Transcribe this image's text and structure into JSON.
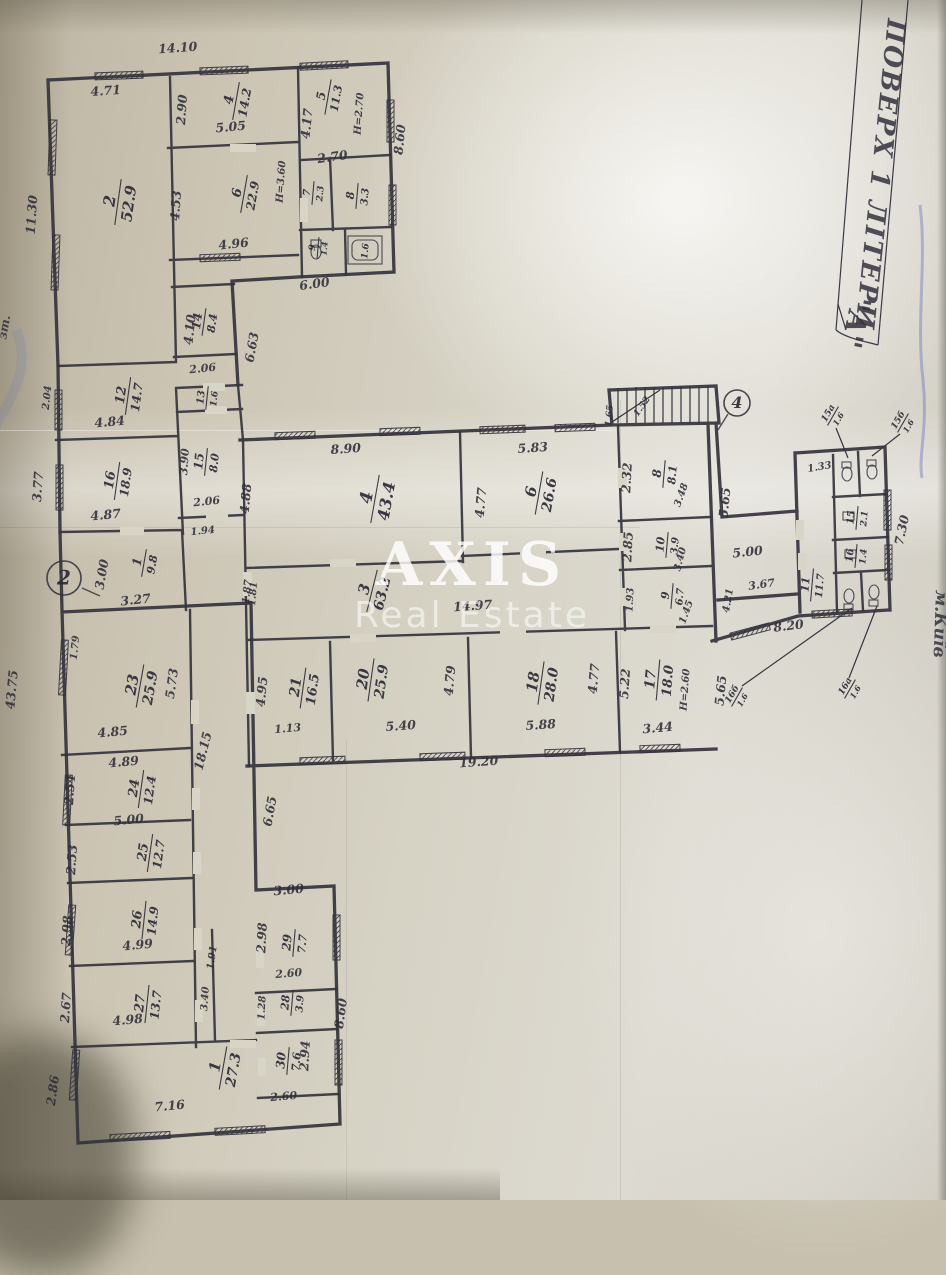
{
  "document": {
    "side_title": "ПОВЕРХ 1 ЛІТЕРИ",
    "side_letter": "\"А\"",
    "city_note": "м.Київ",
    "margin_note": "зт.",
    "watermark": {
      "line1": "AXIS",
      "line2": "Real Estate"
    },
    "ink_color": "#34333d",
    "paper_color": "#d6d2c4"
  },
  "plan": {
    "markers": [
      {
        "label": "2",
        "x": 64,
        "y": 578,
        "r": 17,
        "ax": 82,
        "ay": 588,
        "bx": 100,
        "by": 596
      },
      {
        "label": "4",
        "x": 737,
        "y": 403,
        "r": 13,
        "ax": 728,
        "ay": 414,
        "bx": 718,
        "by": 430
      }
    ],
    "rooms": [
      {
        "n": "2",
        "a": "52.9",
        "x": 118,
        "y": 202,
        "rot": -82,
        "s": 16
      },
      {
        "n": "4",
        "a": "14.2",
        "x": 236,
        "y": 101,
        "rot": -80,
        "s": 13
      },
      {
        "n": "6",
        "a": "22.9",
        "x": 244,
        "y": 194,
        "rot": -80,
        "s": 13
      },
      {
        "n": "5",
        "a": "11.3",
        "x": 328,
        "y": 97,
        "rot": -80,
        "s": 12
      },
      {
        "n": "7",
        "a": "2.3",
        "x": 313,
        "y": 193,
        "rot": -85,
        "s": 10
      },
      {
        "n": "8",
        "a": "3.3",
        "x": 357,
        "y": 196,
        "rot": -85,
        "s": 11
      },
      {
        "n": "9",
        "a": "1.4",
        "x": 318,
        "y": 248,
        "rot": -85,
        "s": 9
      },
      {
        "n": null,
        "a": "1.6",
        "x": 364,
        "y": 251,
        "rot": -85,
        "s": 9
      },
      {
        "n": "14",
        "a": "8.4",
        "x": 204,
        "y": 322,
        "rot": -82,
        "s": 12
      },
      {
        "n": "12",
        "a": "14.7",
        "x": 128,
        "y": 396,
        "rot": -82,
        "s": 13
      },
      {
        "n": "13",
        "a": "1.6",
        "x": 207,
        "y": 398,
        "rot": -84,
        "s": 10
      },
      {
        "n": "15",
        "a": "8.0",
        "x": 206,
        "y": 462,
        "rot": -84,
        "s": 12
      },
      {
        "n": "16",
        "a": "18.9",
        "x": 117,
        "y": 481,
        "rot": -82,
        "s": 13
      },
      {
        "n": "1",
        "a": "9.8",
        "x": 144,
        "y": 563,
        "rot": -80,
        "s": 12
      },
      {
        "n": "23",
        "a": "25.9",
        "x": 140,
        "y": 686,
        "rot": -80,
        "s": 15
      },
      {
        "n": "24",
        "a": "12.4",
        "x": 141,
        "y": 789,
        "rot": -82,
        "s": 13
      },
      {
        "n": "25",
        "a": "12.7",
        "x": 150,
        "y": 853,
        "rot": -82,
        "s": 13
      },
      {
        "n": "26",
        "a": "14.9",
        "x": 144,
        "y": 920,
        "rot": -84,
        "s": 13
      },
      {
        "n": "27",
        "a": "13.7",
        "x": 147,
        "y": 1004,
        "rot": -84,
        "s": 13
      },
      {
        "n": "1",
        "a": "27.3",
        "x": 223,
        "y": 1068,
        "rot": -80,
        "s": 15
      },
      {
        "n": "29",
        "a": "7.7",
        "x": 294,
        "y": 943,
        "rot": -85,
        "s": 12
      },
      {
        "n": "28",
        "a": "3.9",
        "x": 292,
        "y": 1003,
        "rot": -85,
        "s": 11
      },
      {
        "n": "30",
        "a": "7.6",
        "x": 288,
        "y": 1061,
        "rot": -85,
        "s": 12
      },
      {
        "n": "4",
        "a": "43.4",
        "x": 375,
        "y": 499,
        "rot": -80,
        "s": 17
      },
      {
        "n": "6",
        "a": "26.6",
        "x": 539,
        "y": 493,
        "rot": -80,
        "s": 15
      },
      {
        "n": "3",
        "a": "63.2",
        "x": 372,
        "y": 591,
        "rot": -76,
        "s": 15
      },
      {
        "n": "8",
        "a": "8.1",
        "x": 664,
        "y": 474,
        "rot": -85,
        "s": 12
      },
      {
        "n": "10",
        "a": "3.9",
        "x": 667,
        "y": 545,
        "rot": -85,
        "s": 11
      },
      {
        "n": "9",
        "a": "6.7",
        "x": 672,
        "y": 596,
        "rot": -85,
        "s": 11
      },
      {
        "n": "21",
        "a": "16.5",
        "x": 303,
        "y": 688,
        "rot": -82,
        "s": 14
      },
      {
        "n": "20",
        "a": "25.9",
        "x": 371,
        "y": 680,
        "rot": -82,
        "s": 15
      },
      {
        "n": "18",
        "a": "28.0",
        "x": 541,
        "y": 683,
        "rot": -82,
        "s": 15
      },
      {
        "n": "17",
        "a": "18.0",
        "x": 658,
        "y": 680,
        "rot": -85,
        "s": 14
      },
      {
        "n": "11",
        "a": "11.7",
        "x": 812,
        "y": 585,
        "rot": -85,
        "s": 11
      },
      {
        "n": "15",
        "a": "2.1",
        "x": 857,
        "y": 518,
        "rot": -85,
        "s": 10
      },
      {
        "n": "16",
        "a": "1.4",
        "x": 856,
        "y": 556,
        "rot": -85,
        "s": 10
      },
      {
        "n": "15а",
        "a": "1.6",
        "x": 833,
        "y": 416,
        "rot": -60,
        "s": 9
      },
      {
        "n": "15б",
        "a": "1.6",
        "x": 903,
        "y": 423,
        "rot": -60,
        "s": 9
      },
      {
        "n": "16б",
        "a": "1.6",
        "x": 737,
        "y": 697,
        "rot": -60,
        "s": 9
      },
      {
        "n": "16а",
        "a": "1.6",
        "x": 850,
        "y": 689,
        "rot": -60,
        "s": 9
      }
    ],
    "dims": [
      {
        "t": "14.10",
        "x": 178,
        "y": 52,
        "rot": -4
      },
      {
        "t": "4.71",
        "x": 106,
        "y": 95,
        "rot": -4
      },
      {
        "t": "11.30",
        "x": 36,
        "y": 215,
        "rot": -86
      },
      {
        "t": "2.90",
        "x": 186,
        "y": 110,
        "rot": -86
      },
      {
        "t": "5.05",
        "x": 231,
        "y": 131,
        "rot": -5
      },
      {
        "t": "4.53",
        "x": 180,
        "y": 206,
        "rot": -86
      },
      {
        "t": "4.96",
        "x": 234,
        "y": 248,
        "rot": -6
      },
      {
        "t": "Н=3.60",
        "x": 284,
        "y": 182,
        "rot": -86,
        "s": 10
      },
      {
        "t": "4.17",
        "x": 311,
        "y": 124,
        "rot": -84
      },
      {
        "t": "Н=2.70",
        "x": 362,
        "y": 114,
        "rot": -86,
        "s": 10
      },
      {
        "t": "8.60",
        "x": 404,
        "y": 140,
        "rot": -84
      },
      {
        "t": "2.70",
        "x": 333,
        "y": 161,
        "rot": -8
      },
      {
        "t": "6.00",
        "x": 315,
        "y": 288,
        "rot": -8
      },
      {
        "t": "4.10",
        "x": 194,
        "y": 330,
        "rot": -84
      },
      {
        "t": "2.06",
        "x": 203,
        "y": 372,
        "rot": -6,
        "s": 11
      },
      {
        "t": "6.63",
        "x": 256,
        "y": 348,
        "rot": -80
      },
      {
        "t": "3.90",
        "x": 188,
        "y": 462,
        "rot": -86,
        "s": 11
      },
      {
        "t": "2.06",
        "x": 207,
        "y": 505,
        "rot": -6,
        "s": 11
      },
      {
        "t": "1.94",
        "x": 203,
        "y": 534,
        "rot": -6,
        "s": 10
      },
      {
        "t": "1.87",
        "x": 250,
        "y": 592,
        "rot": -84,
        "s": 10
      },
      {
        "t": "4.84",
        "x": 110,
        "y": 426,
        "rot": -5
      },
      {
        "t": "2.04",
        "x": 50,
        "y": 398,
        "rot": -84,
        "s": 10
      },
      {
        "t": "4.87",
        "x": 106,
        "y": 519,
        "rot": -5
      },
      {
        "t": "3.77",
        "x": 42,
        "y": 487,
        "rot": -86
      },
      {
        "t": "3.00",
        "x": 106,
        "y": 575,
        "rot": -80
      },
      {
        "t": "3.27",
        "x": 136,
        "y": 604,
        "rot": -6
      },
      {
        "t": "43.75",
        "x": 16,
        "y": 690,
        "rot": -85
      },
      {
        "t": "1.79",
        "x": 78,
        "y": 648,
        "rot": -84,
        "s": 10
      },
      {
        "t": "5.73",
        "x": 176,
        "y": 684,
        "rot": -82
      },
      {
        "t": "18.15",
        "x": 207,
        "y": 752,
        "rot": -76
      },
      {
        "t": "4.85",
        "x": 113,
        "y": 736,
        "rot": -5
      },
      {
        "t": "4.89",
        "x": 124,
        "y": 766,
        "rot": -5
      },
      {
        "t": "2.54",
        "x": 74,
        "y": 790,
        "rot": -86
      },
      {
        "t": "5.00",
        "x": 129,
        "y": 824,
        "rot": -5
      },
      {
        "t": "2.53",
        "x": 76,
        "y": 860,
        "rot": -86
      },
      {
        "t": "4.99",
        "x": 138,
        "y": 949,
        "rot": -5
      },
      {
        "t": "2.98",
        "x": 71,
        "y": 931,
        "rot": -86
      },
      {
        "t": "4.98",
        "x": 128,
        "y": 1024,
        "rot": -5
      },
      {
        "t": "2.67",
        "x": 70,
        "y": 1008,
        "rot": -86
      },
      {
        "t": "1.91",
        "x": 215,
        "y": 958,
        "rot": -82,
        "s": 10
      },
      {
        "t": "3.40",
        "x": 208,
        "y": 999,
        "rot": -86,
        "s": 10
      },
      {
        "t": "7.16",
        "x": 170,
        "y": 1110,
        "rot": -5
      },
      {
        "t": "2.86",
        "x": 57,
        "y": 1091,
        "rot": -82
      },
      {
        "t": "6.65",
        "x": 274,
        "y": 812,
        "rot": -80
      },
      {
        "t": "3.00",
        "x": 289,
        "y": 894,
        "rot": -5
      },
      {
        "t": "2.98",
        "x": 266,
        "y": 938,
        "rot": -87
      },
      {
        "t": "2.60",
        "x": 289,
        "y": 977,
        "rot": -5,
        "s": 11
      },
      {
        "t": "1.28",
        "x": 265,
        "y": 1008,
        "rot": -87,
        "s": 10
      },
      {
        "t": "2.94",
        "x": 309,
        "y": 1056,
        "rot": -87
      },
      {
        "t": "2.60",
        "x": 284,
        "y": 1100,
        "rot": -5,
        "s": 11
      },
      {
        "t": "8.60",
        "x": 345,
        "y": 1014,
        "rot": -82
      },
      {
        "t": "8.90",
        "x": 346,
        "y": 453,
        "rot": -4
      },
      {
        "t": "4.88",
        "x": 250,
        "y": 499,
        "rot": -85
      },
      {
        "t": "5.83",
        "x": 533,
        "y": 452,
        "rot": -4
      },
      {
        "t": "4.77",
        "x": 485,
        "y": 503,
        "rot": -85
      },
      {
        "t": "1.81",
        "x": 256,
        "y": 594,
        "rot": -85,
        "s": 10
      },
      {
        "t": "14.97",
        "x": 473,
        "y": 610,
        "rot": -4
      },
      {
        "t": "4.95",
        "x": 266,
        "y": 692,
        "rot": -85
      },
      {
        "t": "1.13",
        "x": 288,
        "y": 732,
        "rot": -5,
        "s": 11
      },
      {
        "t": "5.40",
        "x": 401,
        "y": 730,
        "rot": -4
      },
      {
        "t": "4.79",
        "x": 454,
        "y": 681,
        "rot": -85
      },
      {
        "t": "5.88",
        "x": 541,
        "y": 729,
        "rot": -4
      },
      {
        "t": "4.77",
        "x": 598,
        "y": 679,
        "rot": -85
      },
      {
        "t": "5.22",
        "x": 629,
        "y": 684,
        "rot": -86
      },
      {
        "t": "3.44",
        "x": 658,
        "y": 732,
        "rot": -5
      },
      {
        "t": "Н=2.60",
        "x": 688,
        "y": 690,
        "rot": -86,
        "s": 10
      },
      {
        "t": "5.65",
        "x": 725,
        "y": 691,
        "rot": -84
      },
      {
        "t": "19.20",
        "x": 479,
        "y": 766,
        "rot": -4
      },
      {
        "t": "2.32",
        "x": 631,
        "y": 478,
        "rot": -87
      },
      {
        "t": "3.48",
        "x": 684,
        "y": 496,
        "rot": -70,
        "s": 10
      },
      {
        "t": "2.85",
        "x": 632,
        "y": 547,
        "rot": -87
      },
      {
        "t": "3.40",
        "x": 683,
        "y": 560,
        "rot": -75,
        "s": 10
      },
      {
        "t": "1.93",
        "x": 633,
        "y": 600,
        "rot": -87,
        "s": 10
      },
      {
        "t": "1.45",
        "x": 689,
        "y": 613,
        "rot": -70,
        "s": 10
      },
      {
        "t": "5.65",
        "x": 729,
        "y": 503,
        "rot": -84
      },
      {
        "t": "1.52",
        "x": 644,
        "y": 408,
        "rot": -55,
        "s": 9
      },
      {
        "t": "1.65",
        "x": 612,
        "y": 416,
        "rot": -85,
        "s": 9
      },
      {
        "t": "5.00",
        "x": 748,
        "y": 556,
        "rot": -6
      },
      {
        "t": "3.67",
        "x": 762,
        "y": 588,
        "rot": -8,
        "s": 11
      },
      {
        "t": "4.21",
        "x": 731,
        "y": 601,
        "rot": -80,
        "s": 10
      },
      {
        "t": "8.20",
        "x": 789,
        "y": 630,
        "rot": -7
      },
      {
        "t": "1.33",
        "x": 820,
        "y": 470,
        "rot": -10,
        "s": 10
      },
      {
        "t": "7.30",
        "x": 906,
        "y": 531,
        "rot": -78
      }
    ]
  }
}
